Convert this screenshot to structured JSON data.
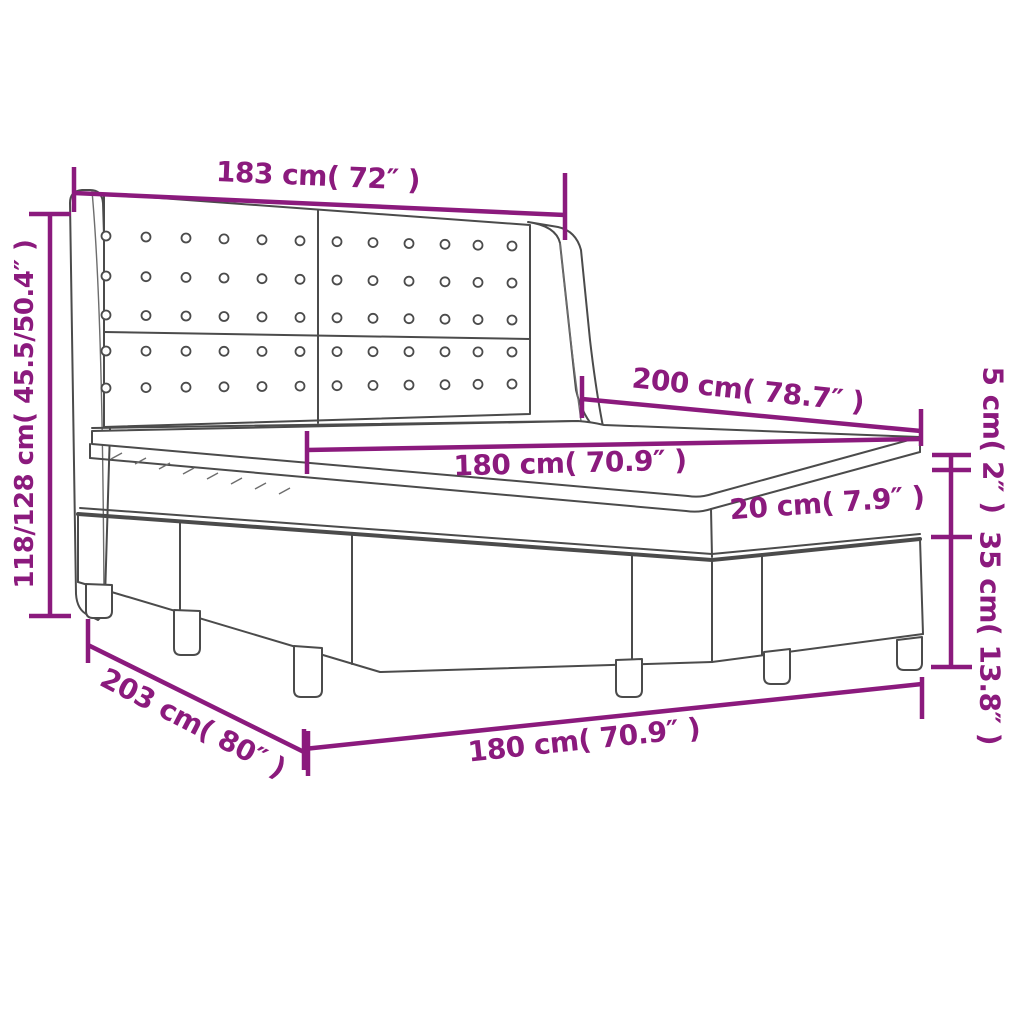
{
  "diagram": {
    "subject": "box spring bed with tufted wing headboard, mattress, topper and base on legs",
    "labels": {
      "headboard_width": "183 cm( 72″ )",
      "headboard_height": "118/128 cm( 45.5/50.4″ )",
      "bed_length": "200 cm( 78.7″ )",
      "mattress_width": "180 cm( 70.9″ )",
      "mattress_thickness": "20 cm( 7.9″ )",
      "topper_thickness": "5 cm( 2″ )",
      "base_height": "35 cm( 13.8″ )",
      "base_length": "203 cm( 80″ )",
      "base_width": "180 cm( 70.9″ )"
    },
    "colors": {
      "dimension_accent": "#8B1A7D",
      "outline_gray": "#4b4b4b",
      "background": "#ffffff"
    }
  }
}
